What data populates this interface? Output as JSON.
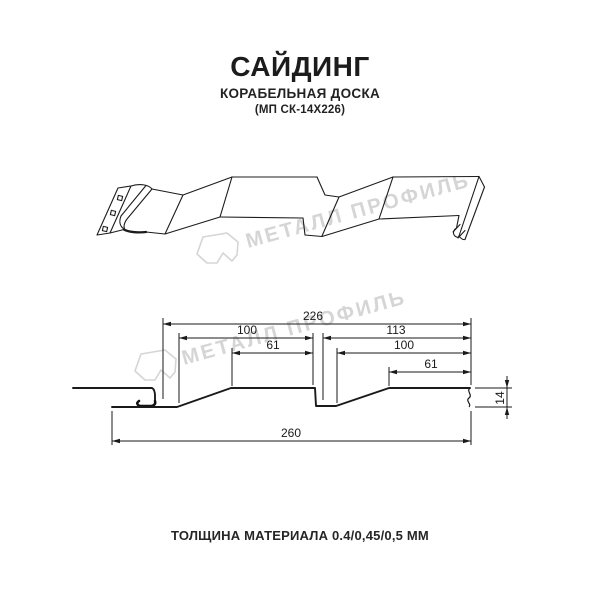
{
  "header": {
    "title": "САЙДИНГ",
    "subtitle": "КОРАБЕЛЬНАЯ ДОСКА",
    "product_code": "(МП СК-14Х226)"
  },
  "watermark": {
    "brand_text": "МЕТАЛЛ ПРОФИЛЬ"
  },
  "drawing": {
    "type": "siding-profile-technical-drawing",
    "dimension_labels_mm": {
      "overall_width": "226",
      "left_panel_width": "100",
      "left_panel_flat": "61",
      "right_span": "113",
      "right_panel_width": "100",
      "right_panel_flat": "61",
      "total_bottom_width": "260",
      "profile_height": "14"
    }
  },
  "footer": {
    "thickness_note": "ТОЛЩИНА МАТЕРИАЛА 0.4/0,45/0,5 ММ"
  }
}
